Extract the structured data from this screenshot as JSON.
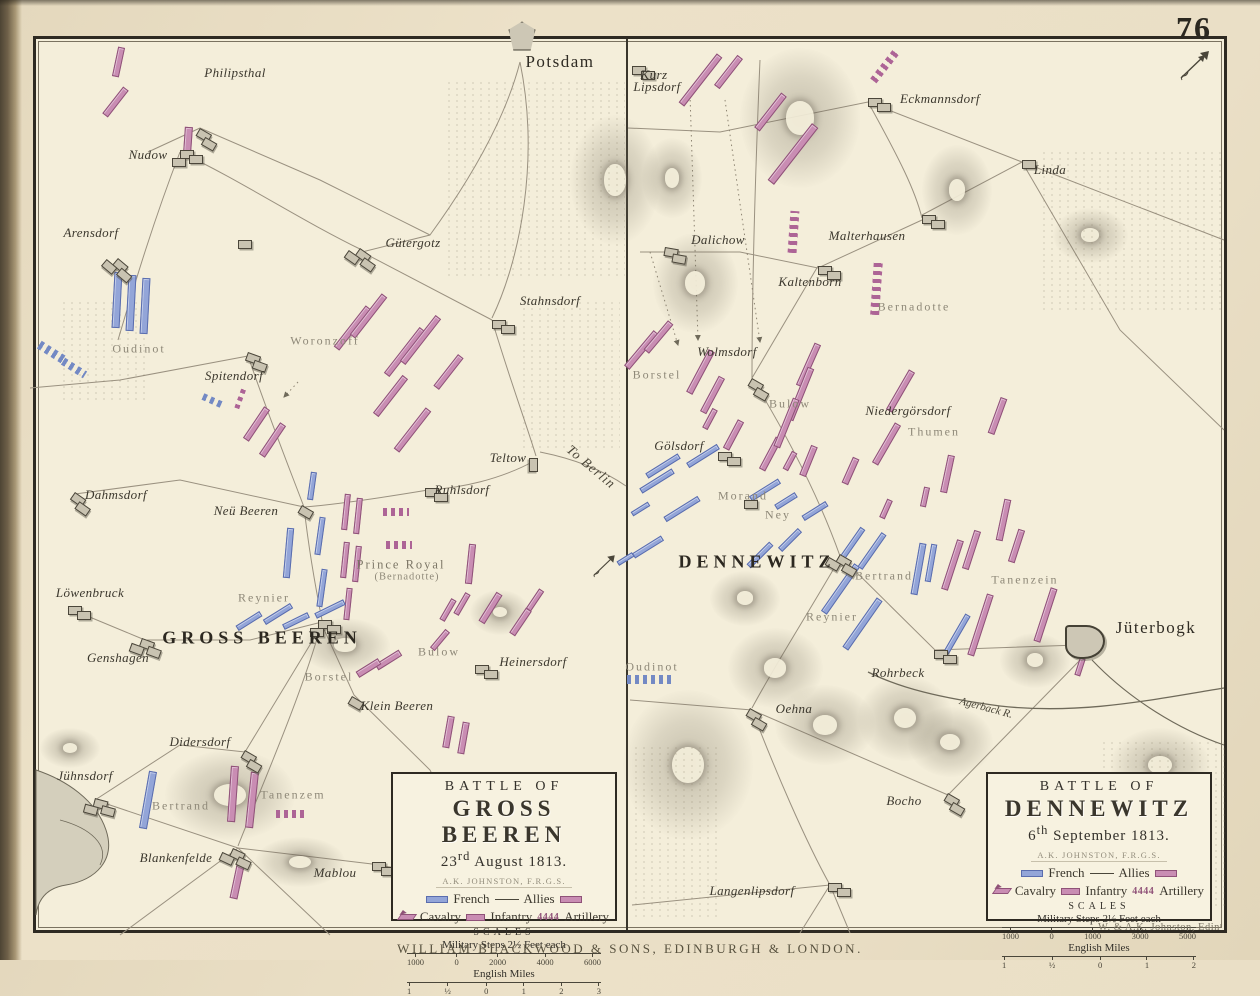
{
  "page": {
    "number": "76",
    "publisher_caption": "WILLIAM BLACKWOOD & SONS, EDINBURGH & LONDON.",
    "engraver": "W. & A.K. Johnston, Edinʳ"
  },
  "colors": {
    "paper": "#f4eeda",
    "page_background": "#eadfc6",
    "french_blue": "#93a5d8",
    "allies_pink": "#c98db3",
    "ink": "#2e2a22",
    "grey_label": "#8e8878"
  },
  "left_map": {
    "legend": {
      "battle_of": "BATTLE OF",
      "title": "GROSS BEEREN",
      "date_day": "23",
      "date_sup": "rd",
      "date_rest": " August 1813.",
      "author": "A.K. JOHNSTON, F.R.G.S.",
      "french_label": "French",
      "allies_label": "Allies",
      "cavalry_label": "Cavalry",
      "infantry_label": "Infantry",
      "artillery_label": "Artillery",
      "artillery_glyph": "4444",
      "scales_label": "SCALES",
      "steps_label": "Military Steps 2½ Feet each",
      "steps_ticks": [
        "1000",
        "0",
        "2000",
        "4000",
        "6000"
      ],
      "miles_label": "English Miles",
      "miles_ticks": [
        "1",
        "½",
        "0",
        "1",
        "2",
        "3"
      ]
    }
  },
  "right_map": {
    "legend": {
      "battle_of": "BATTLE OF",
      "title": "DENNEWITZ",
      "date_day": "6",
      "date_sup": "th",
      "date_rest": " September 1813.",
      "author": "A.K. JOHNSTON, F.R.G.S.",
      "french_label": "French",
      "allies_label": "Allies",
      "cavalry_label": "Cavalry",
      "infantry_label": "Infantry",
      "artillery_label": "Artillery",
      "artillery_glyph": "4444",
      "scales_label": "SCALES",
      "steps_label": "Military Steps 2½ Feet each",
      "steps_ticks": [
        "1000",
        "0",
        "1000",
        "3000",
        "5000"
      ],
      "miles_label": "English Miles",
      "miles_ticks": [
        "1",
        "½",
        "0",
        "1",
        "2"
      ]
    }
  },
  "labels": [
    [
      "Potsdam",
      560,
      62,
      "city",
      0
    ],
    [
      "Philipsthal",
      235,
      73,
      "town",
      0
    ],
    [
      "Nudow",
      148,
      155,
      "town",
      0
    ],
    [
      "Arensdorf",
      91,
      233,
      "town",
      0
    ],
    [
      "Oudinot",
      139,
      349,
      "cmdr",
      0
    ],
    [
      "Gütergotz",
      413,
      243,
      "town",
      0
    ],
    [
      "Woronzoff",
      325,
      341,
      "cmdr",
      0
    ],
    [
      "Spitendorf",
      234,
      376,
      "town",
      0
    ],
    [
      "Stahnsdorf",
      550,
      301,
      "town",
      0
    ],
    [
      "Teltow",
      508,
      458,
      "town",
      0
    ],
    [
      "To Berlin",
      591,
      467,
      "dir",
      40
    ],
    [
      "Ruhlsdorf",
      462,
      490,
      "town",
      0
    ],
    [
      "Dahmsdorf",
      116,
      495,
      "town",
      0
    ],
    [
      "Neü Beeren",
      246,
      511,
      "town",
      0
    ],
    [
      "Prince Royal",
      401,
      565,
      "cmdr2",
      0
    ],
    [
      "(Bernadotte)",
      407,
      577,
      "cmdr3",
      0
    ],
    [
      "Löwenbruck",
      90,
      593,
      "town",
      0
    ],
    [
      "Reynier",
      264,
      598,
      "cmdr",
      0
    ],
    [
      "GROSS BEEREN",
      262,
      638,
      "battle",
      0
    ],
    [
      "Genshagen",
      118,
      658,
      "town",
      0
    ],
    [
      "Borstel",
      329,
      677,
      "cmdr",
      0
    ],
    [
      "Bulow",
      439,
      652,
      "cmdr",
      0
    ],
    [
      "Heinersdorf",
      533,
      662,
      "town",
      0
    ],
    [
      "Klein Beeren",
      397,
      706,
      "town",
      0
    ],
    [
      "Didersdorf",
      200,
      742,
      "town",
      0
    ],
    [
      "Jühnsdorf",
      85,
      776,
      "town",
      0
    ],
    [
      "Bertrand",
      181,
      806,
      "cmdr",
      0
    ],
    [
      "Tanenzem",
      293,
      795,
      "cmdr",
      0
    ],
    [
      "Blankenfelde",
      176,
      858,
      "town",
      0
    ],
    [
      "Mablou",
      335,
      873,
      "town",
      0
    ],
    [
      "Kurz",
      654,
      75,
      "town",
      0
    ],
    [
      "Lipsdorf",
      657,
      87,
      "town",
      0
    ],
    [
      "Eckmannsdorf",
      940,
      99,
      "town",
      0
    ],
    [
      "Linda",
      1050,
      170,
      "town",
      0
    ],
    [
      "Dalichow",
      718,
      240,
      "town",
      0
    ],
    [
      "Malterhausen",
      867,
      236,
      "town",
      0
    ],
    [
      "Kaltenborn",
      810,
      282,
      "town",
      0
    ],
    [
      "Bernadotte",
      914,
      307,
      "cmdr",
      0
    ],
    [
      "Wolmsdorf",
      727,
      352,
      "town",
      0
    ],
    [
      "Borstel",
      657,
      375,
      "cmdr",
      0
    ],
    [
      "Bulow",
      790,
      404,
      "cmdr",
      0
    ],
    [
      "Niedergörsdorf",
      908,
      411,
      "town",
      0
    ],
    [
      "Thumen",
      934,
      432,
      "cmdr",
      0
    ],
    [
      "Gölsdorf",
      679,
      446,
      "town",
      0
    ],
    [
      "Morand",
      743,
      496,
      "cmdr",
      0
    ],
    [
      "Ney",
      778,
      515,
      "cmdr",
      0
    ],
    [
      "DENNEWITZ",
      757,
      562,
      "battle",
      0
    ],
    [
      "Bertrand",
      884,
      576,
      "cmdr",
      0
    ],
    [
      "Tanenzein",
      1025,
      580,
      "cmdr",
      0
    ],
    [
      "Reynier",
      832,
      617,
      "cmdr",
      0
    ],
    [
      "Jüterbogk",
      1156,
      628,
      "city",
      0
    ],
    [
      "Oudinot",
      652,
      667,
      "cmdr",
      0
    ],
    [
      "Rohrbeck",
      898,
      673,
      "town",
      0
    ],
    [
      "Agerback R.",
      986,
      708,
      "river",
      15
    ],
    [
      "Oehna",
      794,
      709,
      "town",
      0
    ],
    [
      "Bocho",
      904,
      801,
      "town",
      0
    ],
    [
      "Langenlipsdorf",
      752,
      891,
      "town",
      0
    ]
  ],
  "units": [
    [
      118,
      62,
      7,
      30,
      12,
      "a"
    ],
    [
      115,
      102,
      7,
      34,
      38,
      "a"
    ],
    [
      188,
      140,
      8,
      26,
      4,
      "a"
    ],
    [
      352,
      328,
      7,
      52,
      38,
      "a"
    ],
    [
      368,
      316,
      7,
      52,
      38,
      "a"
    ],
    [
      404,
      352,
      7,
      58,
      38,
      "a"
    ],
    [
      420,
      340,
      7,
      58,
      38,
      "a"
    ],
    [
      390,
      396,
      7,
      48,
      38,
      "a"
    ],
    [
      412,
      430,
      7,
      52,
      38,
      "a"
    ],
    [
      448,
      372,
      7,
      40,
      38,
      "a"
    ],
    [
      256,
      424,
      7,
      38,
      34,
      "a"
    ],
    [
      272,
      440,
      7,
      38,
      34,
      "a"
    ],
    [
      240,
      398,
      5,
      22,
      20,
      "a",
      "art"
    ],
    [
      346,
      512,
      6,
      36,
      6,
      "a"
    ],
    [
      358,
      516,
      6,
      36,
      6,
      "a"
    ],
    [
      345,
      560,
      6,
      36,
      6,
      "a"
    ],
    [
      357,
      564,
      6,
      36,
      6,
      "a"
    ],
    [
      348,
      604,
      6,
      32,
      6,
      "a"
    ],
    [
      396,
      512,
      26,
      8,
      0,
      "a",
      "art"
    ],
    [
      399,
      545,
      26,
      8,
      0,
      "a",
      "art"
    ],
    [
      470,
      564,
      7,
      40,
      6,
      "a"
    ],
    [
      490,
      608,
      7,
      34,
      32,
      "a"
    ],
    [
      520,
      622,
      7,
      30,
      34,
      "a"
    ],
    [
      535,
      600,
      6,
      24,
      34,
      "a"
    ],
    [
      388,
      660,
      7,
      28,
      58,
      "a"
    ],
    [
      368,
      668,
      7,
      26,
      58,
      "a"
    ],
    [
      440,
      640,
      6,
      24,
      40,
      "a"
    ],
    [
      448,
      610,
      6,
      24,
      30,
      "a"
    ],
    [
      462,
      604,
      6,
      24,
      30,
      "a"
    ],
    [
      448,
      732,
      7,
      32,
      10,
      "a"
    ],
    [
      463,
      738,
      7,
      32,
      10,
      "a"
    ],
    [
      233,
      794,
      8,
      56,
      4,
      "a"
    ],
    [
      252,
      800,
      8,
      56,
      6,
      "a"
    ],
    [
      290,
      814,
      28,
      8,
      0,
      "a",
      "art"
    ],
    [
      237,
      882,
      8,
      34,
      12,
      "a"
    ],
    [
      117,
      300,
      8,
      56,
      3,
      "f"
    ],
    [
      131,
      303,
      8,
      56,
      3,
      "f"
    ],
    [
      145,
      306,
      8,
      56,
      3,
      "f"
    ],
    [
      52,
      352,
      30,
      9,
      32,
      "f",
      "art"
    ],
    [
      74,
      368,
      26,
      8,
      32,
      "f",
      "art"
    ],
    [
      212,
      400,
      20,
      7,
      24,
      "f",
      "art"
    ],
    [
      312,
      486,
      6,
      28,
      8,
      "f"
    ],
    [
      288,
      553,
      7,
      50,
      5,
      "f"
    ],
    [
      320,
      536,
      6,
      38,
      8,
      "f"
    ],
    [
      322,
      588,
      6,
      38,
      8,
      "f"
    ],
    [
      278,
      614,
      6,
      32,
      58,
      "f"
    ],
    [
      249,
      621,
      6,
      28,
      58,
      "f"
    ],
    [
      330,
      609,
      6,
      32,
      64,
      "f"
    ],
    [
      296,
      621,
      6,
      28,
      64,
      "f"
    ],
    [
      148,
      800,
      8,
      58,
      10,
      "f"
    ],
    [
      700,
      80,
      7,
      62,
      38,
      "a"
    ],
    [
      728,
      72,
      7,
      38,
      38,
      "a"
    ],
    [
      770,
      112,
      7,
      44,
      38,
      "a"
    ],
    [
      793,
      154,
      8,
      72,
      38,
      "a"
    ],
    [
      885,
      66,
      8,
      38,
      38,
      "a",
      "art"
    ],
    [
      793,
      232,
      9,
      42,
      4,
      "a",
      "art"
    ],
    [
      876,
      288,
      9,
      54,
      4,
      "a",
      "art"
    ],
    [
      641,
      350,
      7,
      46,
      40,
      "a"
    ],
    [
      658,
      337,
      7,
      38,
      40,
      "a"
    ],
    [
      700,
      372,
      7,
      48,
      28,
      "a"
    ],
    [
      712,
      395,
      7,
      40,
      28,
      "a"
    ],
    [
      710,
      419,
      6,
      22,
      28,
      "a"
    ],
    [
      733,
      435,
      7,
      32,
      28,
      "a"
    ],
    [
      770,
      454,
      7,
      36,
      28,
      "a"
    ],
    [
      790,
      461,
      6,
      20,
      28,
      "a"
    ],
    [
      808,
      365,
      7,
      46,
      24,
      "a"
    ],
    [
      800,
      394,
      7,
      56,
      22,
      "a"
    ],
    [
      786,
      423,
      7,
      52,
      22,
      "a"
    ],
    [
      808,
      461,
      7,
      32,
      22,
      "a"
    ],
    [
      850,
      471,
      7,
      28,
      24,
      "a"
    ],
    [
      900,
      391,
      7,
      46,
      30,
      "a"
    ],
    [
      886,
      444,
      7,
      46,
      30,
      "a"
    ],
    [
      947,
      474,
      7,
      38,
      12,
      "a"
    ],
    [
      925,
      497,
      6,
      20,
      12,
      "a"
    ],
    [
      886,
      509,
      6,
      20,
      24,
      "a"
    ],
    [
      997,
      416,
      7,
      38,
      20,
      "a"
    ],
    [
      1003,
      520,
      7,
      42,
      12,
      "a"
    ],
    [
      952,
      565,
      7,
      52,
      18,
      "a"
    ],
    [
      971,
      550,
      7,
      40,
      18,
      "a"
    ],
    [
      980,
      625,
      7,
      64,
      18,
      "a"
    ],
    [
      1016,
      546,
      7,
      34,
      18,
      "a"
    ],
    [
      1045,
      615,
      7,
      56,
      18,
      "a"
    ],
    [
      1080,
      667,
      6,
      18,
      18,
      "a"
    ],
    [
      703,
      456,
      6,
      36,
      58,
      "f"
    ],
    [
      663,
      466,
      6,
      38,
      58,
      "f"
    ],
    [
      657,
      481,
      6,
      38,
      58,
      "f"
    ],
    [
      682,
      509,
      6,
      40,
      58,
      "f"
    ],
    [
      640,
      509,
      5,
      20,
      58,
      "f"
    ],
    [
      648,
      547,
      6,
      34,
      58,
      "f"
    ],
    [
      625,
      559,
      5,
      18,
      58,
      "f"
    ],
    [
      765,
      490,
      6,
      34,
      58,
      "f"
    ],
    [
      786,
      501,
      6,
      24,
      58,
      "f"
    ],
    [
      815,
      511,
      6,
      28,
      58,
      "f"
    ],
    [
      760,
      555,
      6,
      32,
      45,
      "f"
    ],
    [
      790,
      540,
      6,
      28,
      45,
      "f"
    ],
    [
      852,
      544,
      6,
      38,
      35,
      "f"
    ],
    [
      872,
      551,
      6,
      42,
      35,
      "f"
    ],
    [
      840,
      589,
      7,
      58,
      35,
      "f"
    ],
    [
      862,
      624,
      7,
      60,
      35,
      "f"
    ],
    [
      918,
      569,
      7,
      52,
      10,
      "f"
    ],
    [
      931,
      563,
      6,
      38,
      10,
      "f"
    ],
    [
      957,
      634,
      6,
      44,
      30,
      "f"
    ],
    [
      650,
      679,
      46,
      9,
      0,
      "f",
      "art"
    ]
  ],
  "towns": [
    [
      200,
      128,
      30,
      2
    ],
    [
      180,
      150,
      0,
      3
    ],
    [
      118,
      258,
      40,
      3
    ],
    [
      238,
      240,
      0,
      1
    ],
    [
      360,
      248,
      35,
      3
    ],
    [
      492,
      320,
      0,
      2
    ],
    [
      248,
      352,
      20,
      2
    ],
    [
      538,
      458,
      90,
      1
    ],
    [
      425,
      488,
      0,
      2
    ],
    [
      75,
      492,
      35,
      2
    ],
    [
      302,
      505,
      30,
      1
    ],
    [
      68,
      606,
      0,
      2
    ],
    [
      142,
      638,
      20,
      3
    ],
    [
      318,
      620,
      0,
      3
    ],
    [
      475,
      665,
      0,
      2
    ],
    [
      352,
      696,
      30,
      1
    ],
    [
      245,
      750,
      30,
      2
    ],
    [
      95,
      798,
      15,
      3
    ],
    [
      233,
      848,
      25,
      3
    ],
    [
      372,
      862,
      0,
      2
    ],
    [
      522,
      36,
      0,
      1,
      2
    ],
    [
      632,
      66,
      0,
      2
    ],
    [
      868,
      98,
      0,
      2
    ],
    [
      1022,
      160,
      0,
      1
    ],
    [
      665,
      247,
      10,
      2
    ],
    [
      922,
      215,
      0,
      2
    ],
    [
      818,
      266,
      0,
      2
    ],
    [
      752,
      378,
      30,
      2
    ],
    [
      718,
      452,
      0,
      2
    ],
    [
      840,
      554,
      30,
      3
    ],
    [
      744,
      500,
      0,
      1
    ],
    [
      934,
      650,
      0,
      2
    ],
    [
      750,
      708,
      30,
      2
    ],
    [
      948,
      793,
      30,
      2
    ],
    [
      828,
      883,
      0,
      2
    ],
    [
      1085,
      642,
      0,
      0,
      1
    ]
  ],
  "terrain": {
    "hills": [
      [
        615,
        180,
        90,
        130
      ],
      [
        345,
        645,
        90,
        55
      ],
      [
        230,
        795,
        130,
        90
      ],
      [
        300,
        862,
        90,
        50
      ],
      [
        70,
        748,
        60,
        40
      ],
      [
        500,
        612,
        60,
        45
      ],
      [
        800,
        118,
        120,
        140
      ],
      [
        957,
        190,
        70,
        90
      ],
      [
        695,
        283,
        85,
        100
      ],
      [
        672,
        178,
        60,
        80
      ],
      [
        745,
        598,
        70,
        55
      ],
      [
        775,
        668,
        95,
        80
      ],
      [
        825,
        725,
        100,
        80
      ],
      [
        905,
        718,
        95,
        85
      ],
      [
        1035,
        660,
        70,
        55
      ],
      [
        950,
        742,
        85,
        70
      ],
      [
        1160,
        765,
        100,
        75
      ],
      [
        688,
        765,
        130,
        150
      ],
      [
        1090,
        235,
        75,
        55
      ]
    ],
    "speckles": [
      [
        445,
        80,
        180,
        200
      ],
      [
        520,
        300,
        100,
        150
      ],
      [
        1040,
        150,
        185,
        160
      ],
      [
        1100,
        740,
        125,
        170
      ],
      [
        632,
        745,
        85,
        175
      ],
      [
        60,
        300,
        90,
        100
      ]
    ]
  }
}
